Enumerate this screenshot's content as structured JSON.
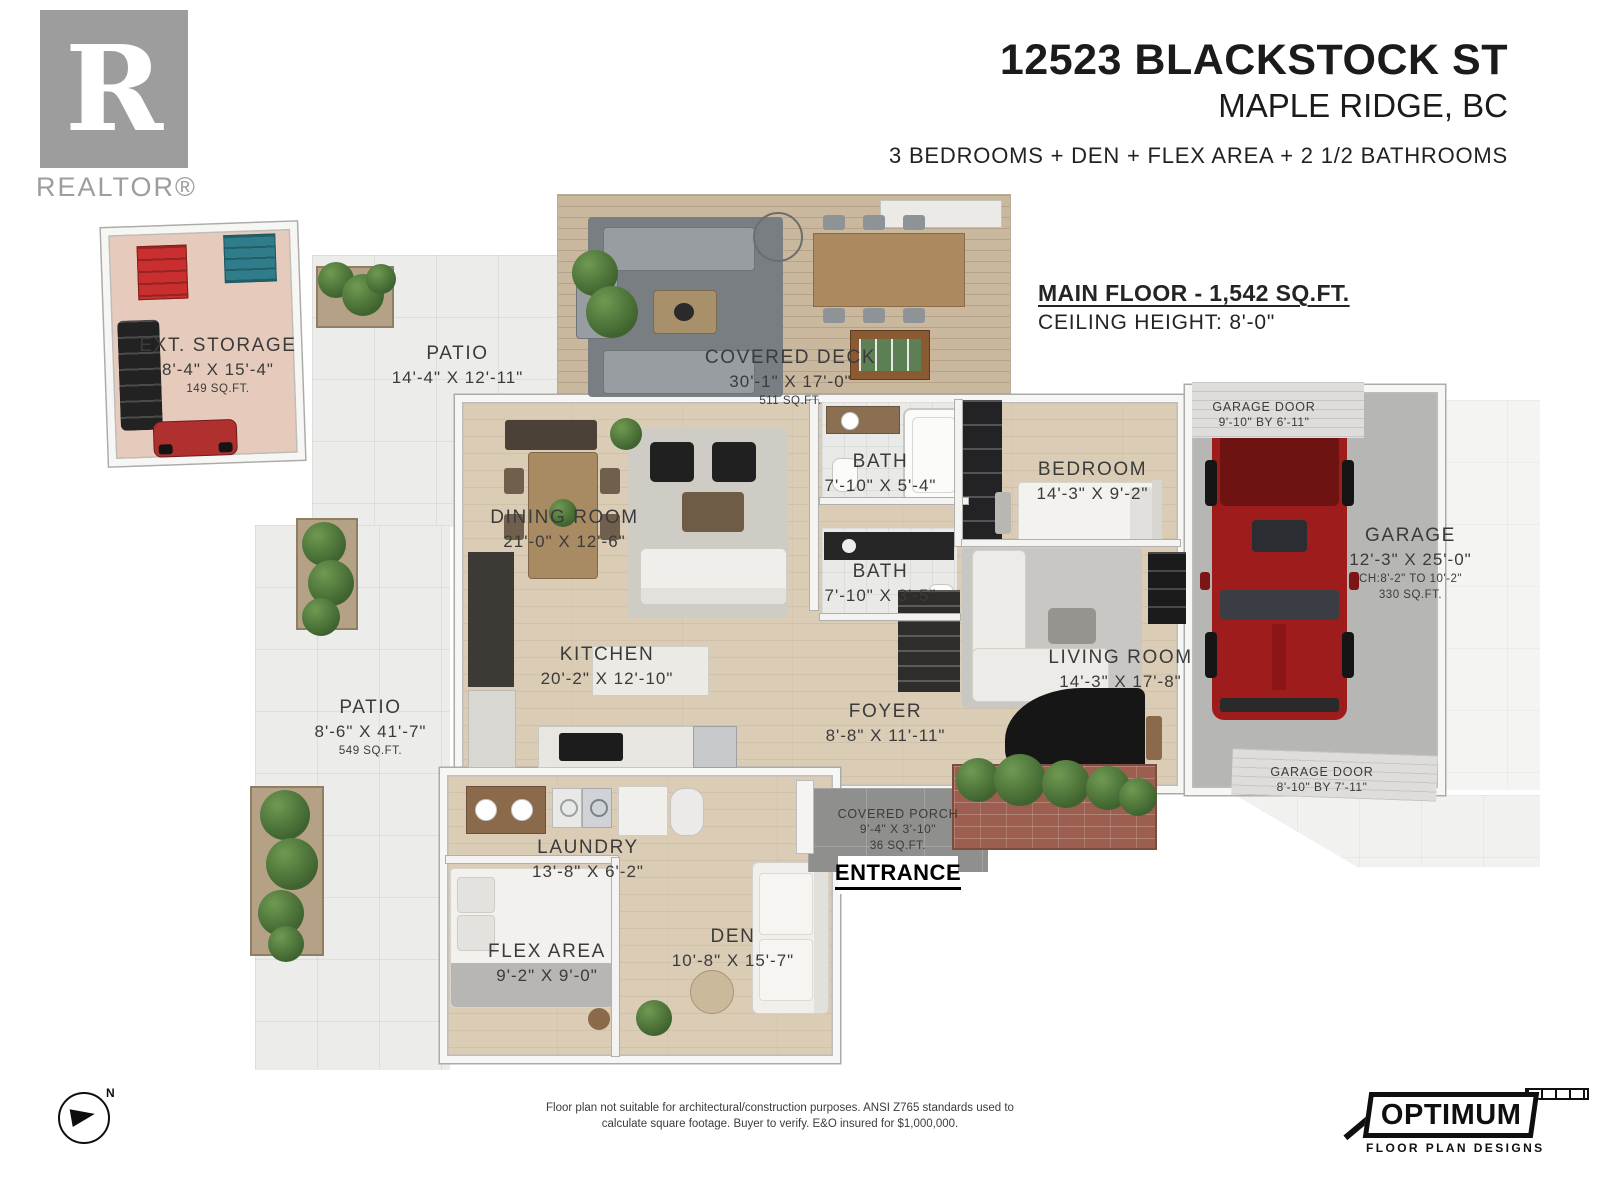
{
  "branding": {
    "realtor_logo_letter": "R",
    "realtor_text": "REALTOR®",
    "optimum_name": "OPTIMUM",
    "optimum_sub": "FLOOR PLAN DESIGNS"
  },
  "header": {
    "address": "12523 BLACKSTOCK ST",
    "city": "MAPLE RIDGE, BC",
    "features": "3 BEDROOMS + DEN + FLEX AREA + 2 1/2 BATHROOMS"
  },
  "floor_info": {
    "title": "MAIN FLOOR - 1,542 SQ.FT.",
    "ceiling": "CEILING HEIGHT: 8'-0\""
  },
  "rooms": {
    "ext_storage": {
      "name": "EXT. STORAGE",
      "dims": "8'-4\" X 15'-4\"",
      "area": "149 SQ.FT."
    },
    "patio_top": {
      "name": "PATIO",
      "dims": "14'-4\" X 12'-11\""
    },
    "covered_deck": {
      "name": "COVERED DECK",
      "dims": "30'-1\" X 17'-0\"",
      "area": "511 SQ.FT."
    },
    "bath_upper": {
      "name": "BATH",
      "dims": "7'-10\" X 5'-4\""
    },
    "bedroom": {
      "name": "BEDROOM",
      "dims": "14'-3\" X 9'-2\""
    },
    "garage_door_upper": {
      "name": "GARAGE DOOR",
      "dims": "9'-10\" BY 6'-11\""
    },
    "garage": {
      "name": "GARAGE",
      "dims": "12'-3\" X 25'-0\"",
      "sub": "CH:8'-2\" TO 10'-2\"",
      "area": "330 SQ.FT."
    },
    "dining_room": {
      "name": "DINING ROOM",
      "dims": "21'-0\" X 12'-6\""
    },
    "bath_lower": {
      "name": "BATH",
      "dims": "7'-10\" X 3'-5\""
    },
    "kitchen": {
      "name": "KITCHEN",
      "dims": "20'-2\" X 12'-10\""
    },
    "living_room": {
      "name": "LIVING ROOM",
      "dims": "14'-3\" X 17'-8\""
    },
    "patio_left": {
      "name": "PATIO",
      "dims": "8'-6\" X 41'-7\"",
      "area": "549 SQ.FT."
    },
    "foyer": {
      "name": "FOYER",
      "dims": "8'-8\" X 11'-11\""
    },
    "garage_door_lower": {
      "name": "GARAGE DOOR",
      "dims": "8'-10\" BY 7'-11\""
    },
    "covered_porch": {
      "name": "COVERED PORCH",
      "dims": "9'-4\" X 3'-10\"",
      "area": "36 SQ.FT."
    },
    "laundry": {
      "name": "LAUNDRY",
      "dims": "13'-8\" X 6'-2\""
    },
    "entrance": {
      "name": "ENTRANCE"
    },
    "flex_area": {
      "name": "FLEX AREA",
      "dims": "9'-2\" X 9'-0\""
    },
    "den": {
      "name": "DEN",
      "dims": "10'-8\" X 15'-7\""
    }
  },
  "compass": {
    "label": "N"
  },
  "footer": {
    "disclaimer_line1": "Floor plan not suitable for architectural/construction purposes. ANSI Z765 standards used to",
    "disclaimer_line2": "calculate square footage. Buyer to verify.  E&O insured for $1,000,000."
  },
  "colors": {
    "truck_red": "#9e1c1c",
    "plant_green": "#4e7a3c",
    "toolbox_red": "#c92f2f",
    "bin_teal": "#2f7d8a",
    "brand_black": "#0f0f0f",
    "realtor_grey": "#9d9d9d"
  }
}
